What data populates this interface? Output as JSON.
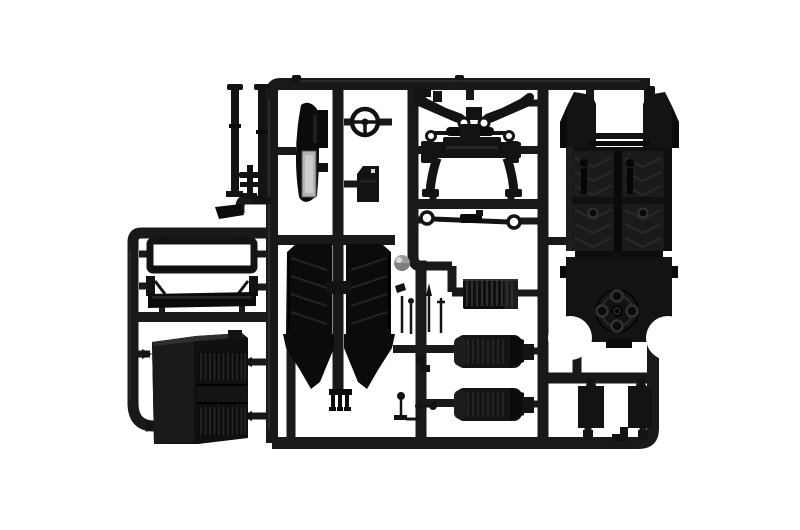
{
  "image": {
    "description": "Product photograph of a black injection-molded plastic model kit sprue (parts tree) for a truck model, laid on a plain white background",
    "background_color": "#ffffff",
    "plastic_color": "#141414",
    "runner_color": "#191919",
    "chrome_highlight_color": "#b3b3b3",
    "knob_color": "#9c9c9c",
    "visible_text": []
  },
  "parts": [
    {
      "id": "exhaust-stack-left",
      "label": "tall exhaust stack rod with base foot"
    },
    {
      "id": "exhaust-stack-right",
      "label": "tall exhaust stack rod with bottom flange"
    },
    {
      "id": "cross-lever-part",
      "label": "small cross-shaped post"
    },
    {
      "id": "exhaust-shield",
      "label": "curved exhaust heat shield with bright metallic panel"
    },
    {
      "id": "steering-wheel",
      "label": "steering wheel with spokes"
    },
    {
      "id": "air-filter-box",
      "label": "small rectangular box part"
    },
    {
      "id": "top-bracket-part",
      "label": "small stepped bracket under top rail"
    },
    {
      "id": "wishbone-assembly",
      "label": "V-shaped steering arm assembly with eyelets"
    },
    {
      "id": "leaf-spring",
      "label": "leaf spring with axle rod and end rings"
    },
    {
      "id": "front-axle",
      "label": "front axle beam with curved legs"
    },
    {
      "id": "tie-rod",
      "label": "tie rod with ring ends"
    },
    {
      "id": "cab-floor-panel",
      "label": "large cab floor panel with chevron tread and window opening"
    },
    {
      "id": "chassis-rear-panel",
      "label": "rear chassis panel with circular hub and wheel arches"
    },
    {
      "id": "window-frame",
      "label": "rectangular window frame"
    },
    {
      "id": "cab-rear-panel",
      "label": "shallow cab rear panel with end posts"
    },
    {
      "id": "radiator-grille",
      "label": "angled radiator grille block with louvre slats"
    },
    {
      "id": "door-panel-left",
      "label": "left door/side panel tapering to a point"
    },
    {
      "id": "door-panel-right",
      "label": "right door/side panel tapering to a point"
    },
    {
      "id": "gear-knob-ball",
      "label": "grey spherical knob"
    },
    {
      "id": "lever-set-upper",
      "label": "cluster of thin control levers"
    },
    {
      "id": "lever-set-lower",
      "label": "cluster of small levers and linkages"
    },
    {
      "id": "fork-part",
      "label": "small three-prong fork part"
    },
    {
      "id": "ribbed-panel",
      "label": "ribbed rectangular panel"
    },
    {
      "id": "seat-middle",
      "label": "ribbed seat part"
    },
    {
      "id": "seat-bottom",
      "label": "ribbed seat part"
    },
    {
      "id": "mudflap-left",
      "label": "rectangular mud flap"
    },
    {
      "id": "mudflap-right",
      "label": "rectangular mud flap"
    },
    {
      "id": "center-tab",
      "label": "small stepped tab on bottom rail"
    }
  ]
}
